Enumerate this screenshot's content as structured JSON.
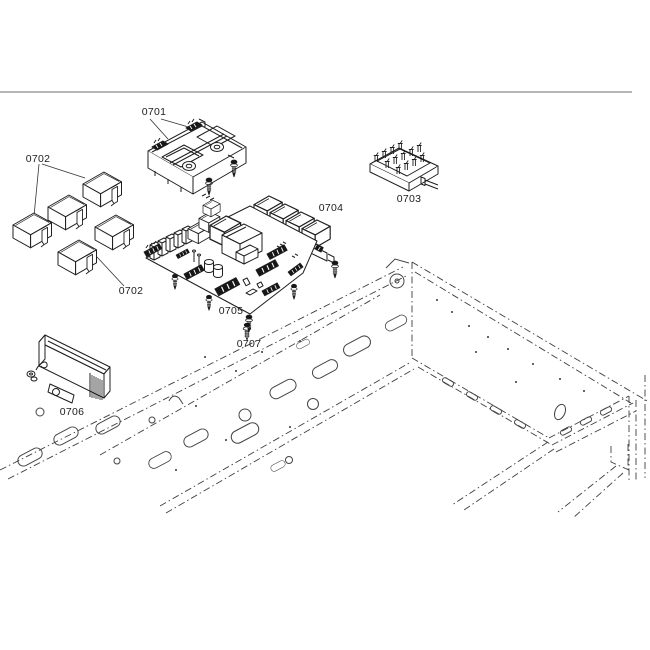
{
  "page": {
    "background": "#ffffff",
    "top_border_color": "#8c8c8c",
    "drawing_line_color": "#1f1f1f",
    "phantom_line_color": "#3f3f3f"
  },
  "diagram_type": "exploded-parts-diagram",
  "callout_labels": [
    {
      "text": "0701"
    },
    {
      "text": "0702"
    },
    {
      "text": "0702"
    },
    {
      "text": "0703"
    },
    {
      "text": "0704"
    },
    {
      "text": "0705"
    },
    {
      "text": "0706"
    },
    {
      "text": "0707"
    }
  ]
}
